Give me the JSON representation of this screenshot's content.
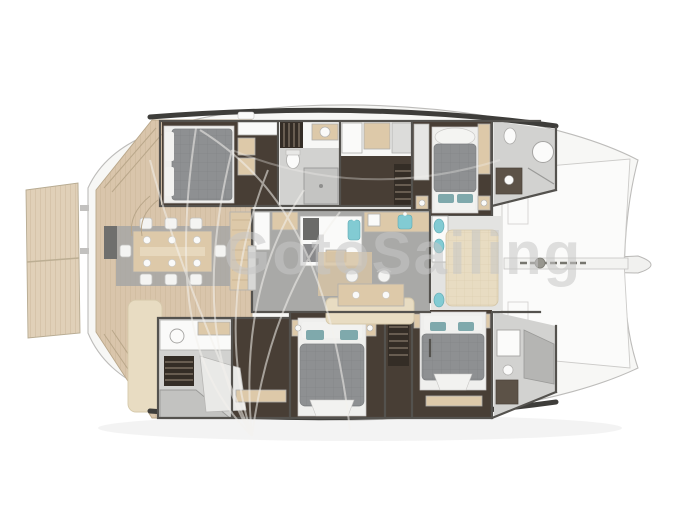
{
  "watermark": {
    "text": "GotoSailing"
  },
  "floorplan": {
    "vessel_type": "sailing-catamaran",
    "view": "overhead-deck-and-interior-layout",
    "regions": {
      "aft": [
        "swim-platform",
        "aft-deck",
        "cockpit-dining-table",
        "cockpit-sofa"
      ],
      "salon": [
        "galley-island",
        "galley-counter",
        "sideboard",
        "dining-table",
        "settee"
      ],
      "top_hull": [
        "aft-cabin",
        "companionway-stairs",
        "bathroom",
        "corridor",
        "forward-cabin",
        "forward-bathroom"
      ],
      "bottom_hull": [
        "aft-bathroom",
        "stairs",
        "mid-cabin",
        "forward-cabin",
        "forward-bathroom"
      ],
      "forward": [
        "forward-cockpit",
        "lounge-pad",
        "foredeck",
        "anchor-track",
        "bowsprit"
      ]
    },
    "furniture_counts": {
      "double_beds": 4,
      "cockpit_chairs": 8,
      "salon_chairs": 2,
      "sinks_teal": 6
    }
  },
  "colors": {
    "bg": "#ffffff",
    "teak": "#d9c5ab",
    "teak_seam": "#c9b294",
    "teak_light": "#e0d0b8",
    "hull_white": "#f7f7f5",
    "hull_outline": "#bdbcba",
    "dark_band": "#3e3d3a",
    "wall": "#54524e",
    "floor_salon": "#a9a9a7",
    "floor_light": "#d2d2d0",
    "floor_cabin": "#483e35",
    "wood": "#ddc9a9",
    "bed_base": "#efefed",
    "duvet": "#8e9092",
    "pillow_white": "#f2f2f0",
    "pillow_teal": "#7fa9ac",
    "sink_teal": "#82cbd3",
    "cushion": "#e8dcc2",
    "gray_mat": "#a6a6a4",
    "white_fixture": "#fafaf9",
    "fixture_outline": "#b0afad",
    "watermark_text": "#c7c7c7",
    "watermark_line": "#f4f2ee",
    "shadow": "#9c9c9a"
  }
}
